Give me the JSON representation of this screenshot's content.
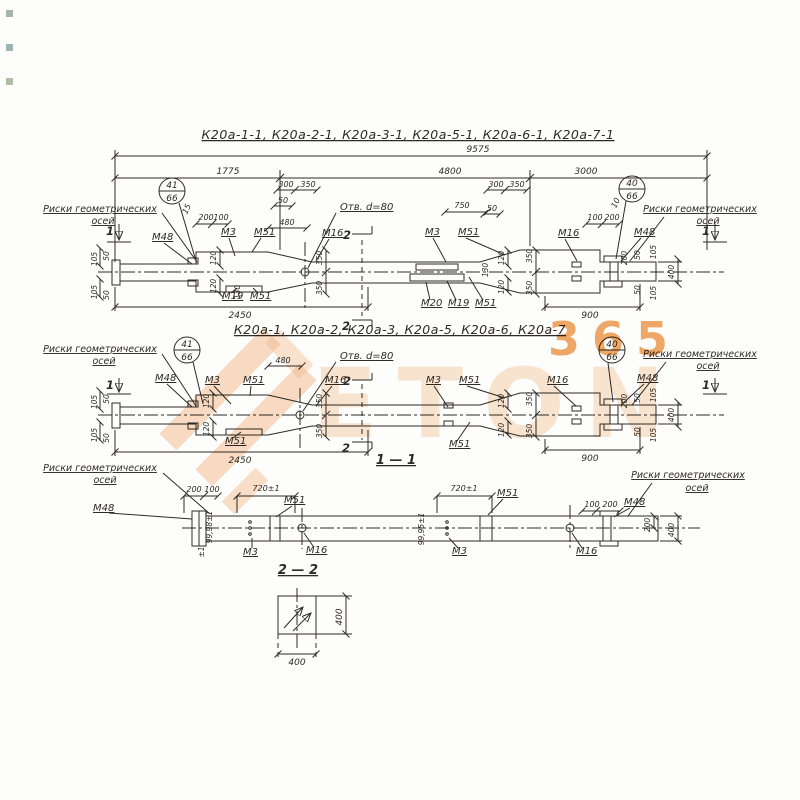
{
  "titles": {
    "row1": "К20а-1-1, К20а-2-1, К20а-3-1, К20а-5-1, К20а-6-1, К20а-7-1",
    "row2": "К20а-1, К20а-2, К20а-3, К20а-5, К20а-6, К20а-7",
    "section11": "1 — 1",
    "section22": "2 — 2"
  },
  "notes": {
    "axis1": "Риски геометрических",
    "axis2": "осей",
    "hole": "Отв. d=80"
  },
  "marks": {
    "m3": "М3",
    "m16": "М16",
    "m19": "М19",
    "m20": "М20",
    "m48": "М48",
    "m51": "М51"
  },
  "positions": {
    "p40": "40",
    "p41": "41",
    "p66": "66"
  },
  "sections": {
    "s1": "1",
    "s2": "2"
  },
  "dims": {
    "d9575": "9575",
    "d1775": "1775",
    "d4800": "4800",
    "d3000": "3000",
    "d2450": "2450",
    "d900": "900",
    "d750": "750",
    "d480": "480",
    "d400": "400",
    "d350": "350",
    "d300": "300",
    "d200": "200",
    "d130": "130",
    "d120": "120",
    "d105": "105",
    "d100": "100",
    "d50": "50",
    "d15": "15",
    "d10": "10",
    "d720": "720±1",
    "tol": "±1",
    "pairA": "99,98±1",
    "pairB": "99,95±1"
  },
  "watermark": {
    "digits": "365",
    "letters": "ETON"
  }
}
